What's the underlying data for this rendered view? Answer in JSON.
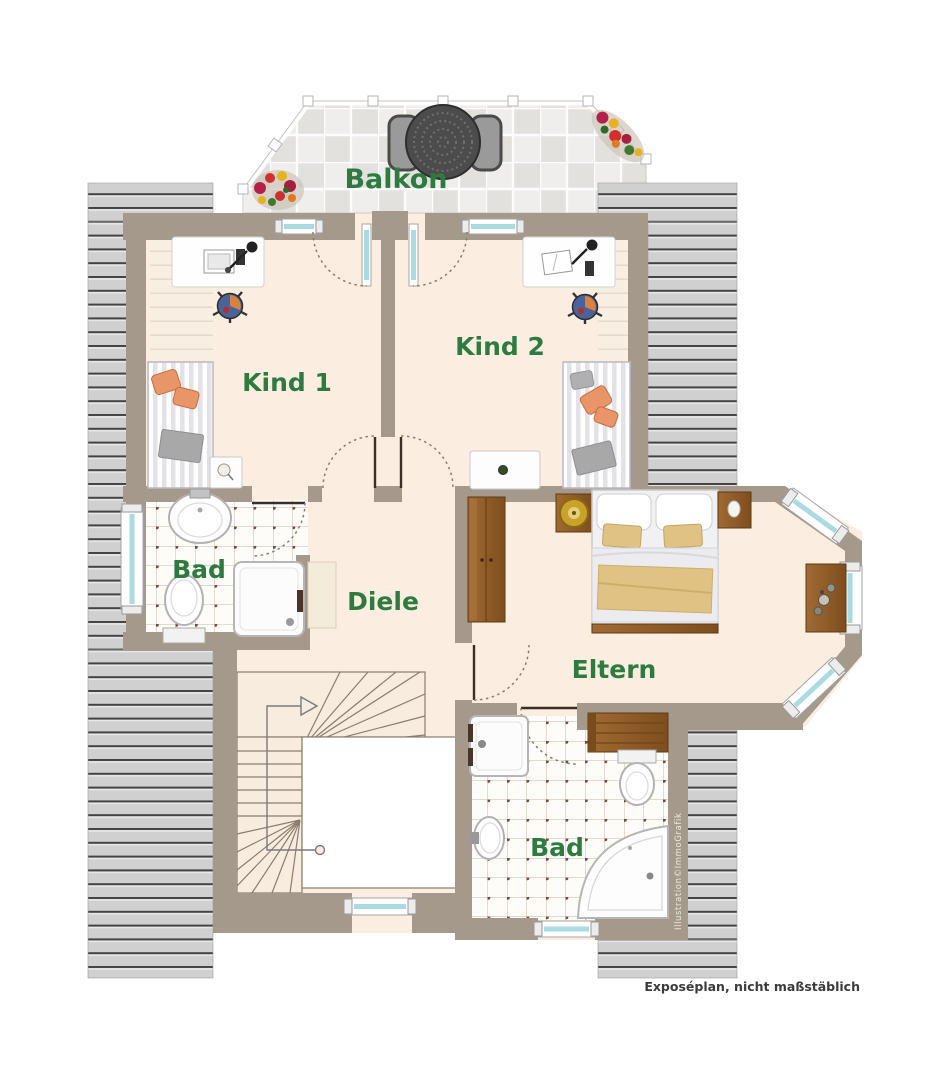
{
  "labels": {
    "balcony": "Balkon",
    "child1": "Kind 1",
    "child2": "Kind 2",
    "bath_upper": "Bad",
    "hall": "Diele",
    "parents": "Eltern",
    "bath_lower": "Bad"
  },
  "footer": {
    "note": "Exposéplan, nicht maßstäblich"
  },
  "watermark": "Illustration©ImmoGrafik",
  "colors": {
    "label_green": "#2e7b40",
    "wall_taupe": "#a5998b",
    "floor_cream": "#fbeee1",
    "roof_gray": "#cfcfcf",
    "wood_brown": "#96622d",
    "accent_orange": "#e8956a",
    "blanket_tan": "#e0c285",
    "window_glass": "#aadbe3",
    "footer_text": "#3b3b3b"
  }
}
